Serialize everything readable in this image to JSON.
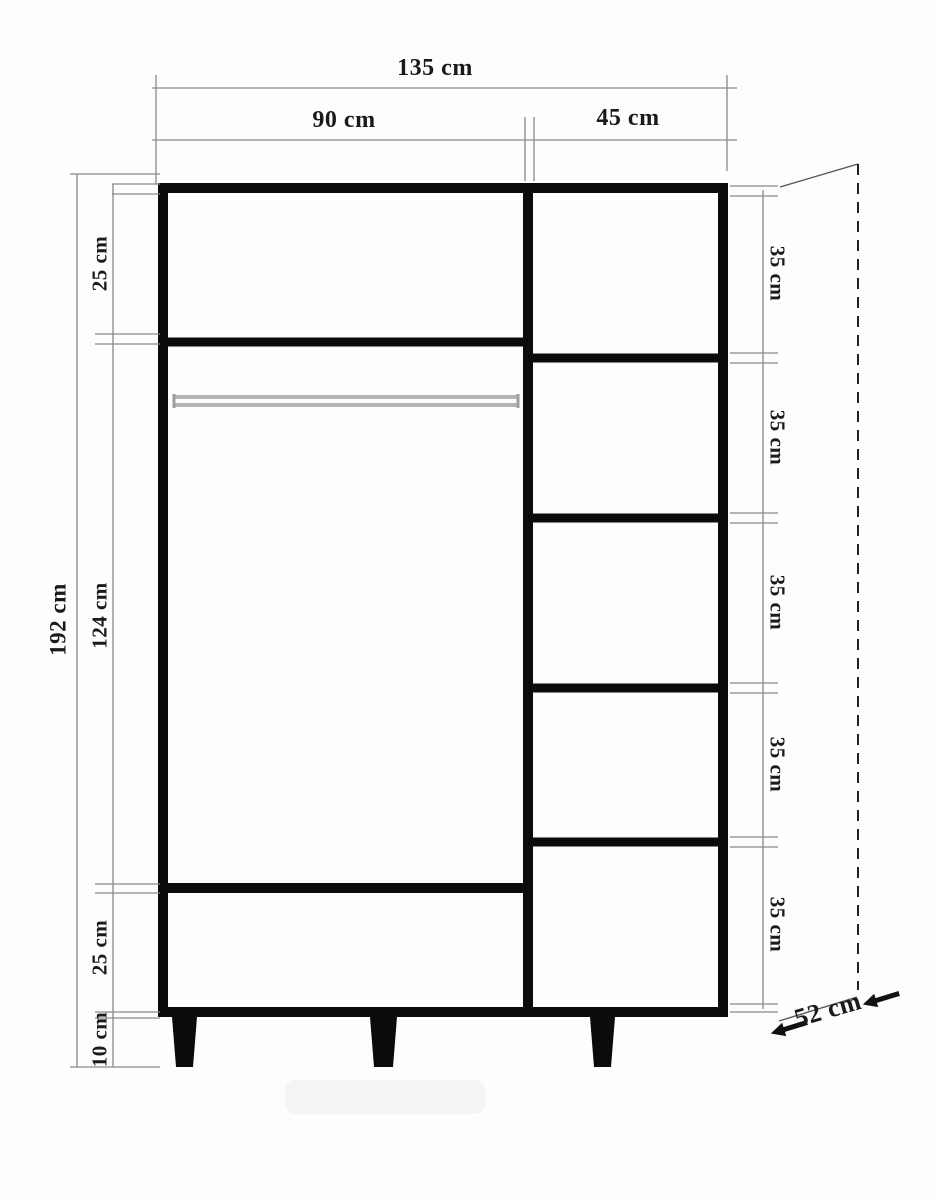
{
  "drawing": {
    "labels": {
      "width_total": "135 cm",
      "width_left_section": "90 cm",
      "width_right_section": "45 cm",
      "height_total": "192 cm",
      "top_shelf_height": "25 cm",
      "hanging_space_height": "124 cm",
      "bottom_shelf_height": "25 cm",
      "legs_height": "10 cm",
      "depth": "52 cm",
      "right_shelf_heights": [
        "35 cm",
        "35 cm",
        "35 cm",
        "35 cm",
        "35 cm"
      ]
    },
    "colors": {
      "outline": "#0b0b0b",
      "dimension_line": "#8a8a8a",
      "text": "#1a1a1a",
      "rod": "#b4b4b4",
      "background": "#fdfdfd"
    }
  }
}
